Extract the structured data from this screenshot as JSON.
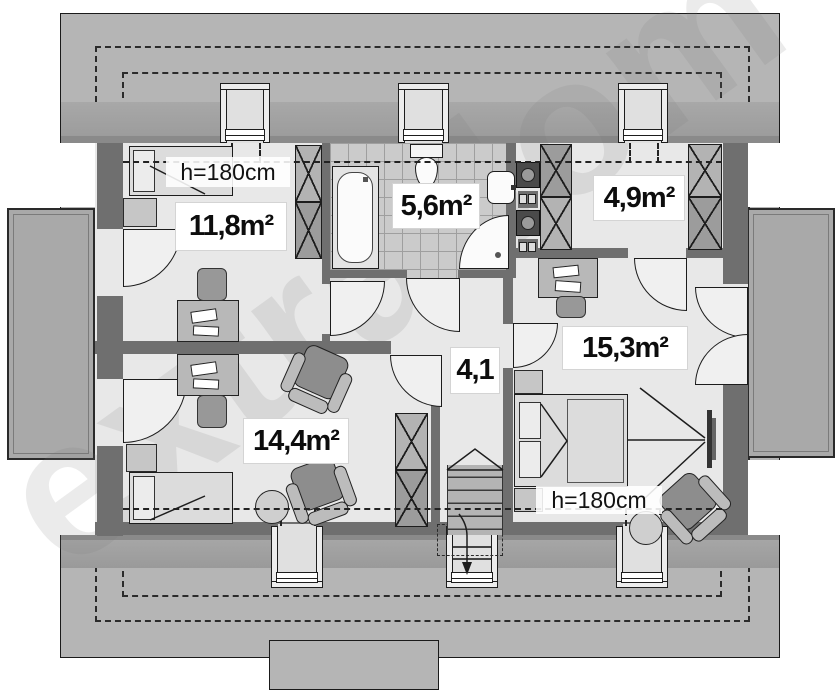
{
  "plan": {
    "watermark": "extradom",
    "rooms": [
      {
        "id": "bedroom-left",
        "area_label": "11,8m²"
      },
      {
        "id": "bathroom",
        "area_label": "5,6m²"
      },
      {
        "id": "wardrobe-room",
        "area_label": "4,9m²"
      },
      {
        "id": "bedroom-right",
        "area_label": "15,3m²"
      },
      {
        "id": "bedroom-bottom",
        "area_label": "14,4m²"
      },
      {
        "id": "hall",
        "area_label": "4,1"
      }
    ],
    "height_notes": {
      "top": "h=180cm",
      "bottom": "h=180cm"
    },
    "colors": {
      "roof_plane": "#b5b5b5",
      "eave_band": "#9e9e9e",
      "wall": "#6f6f6f",
      "floor": "#e8e8e8",
      "terrace": "#a9a9a9",
      "tile": "#cbcbcb",
      "line": "#1d1d1d"
    }
  }
}
